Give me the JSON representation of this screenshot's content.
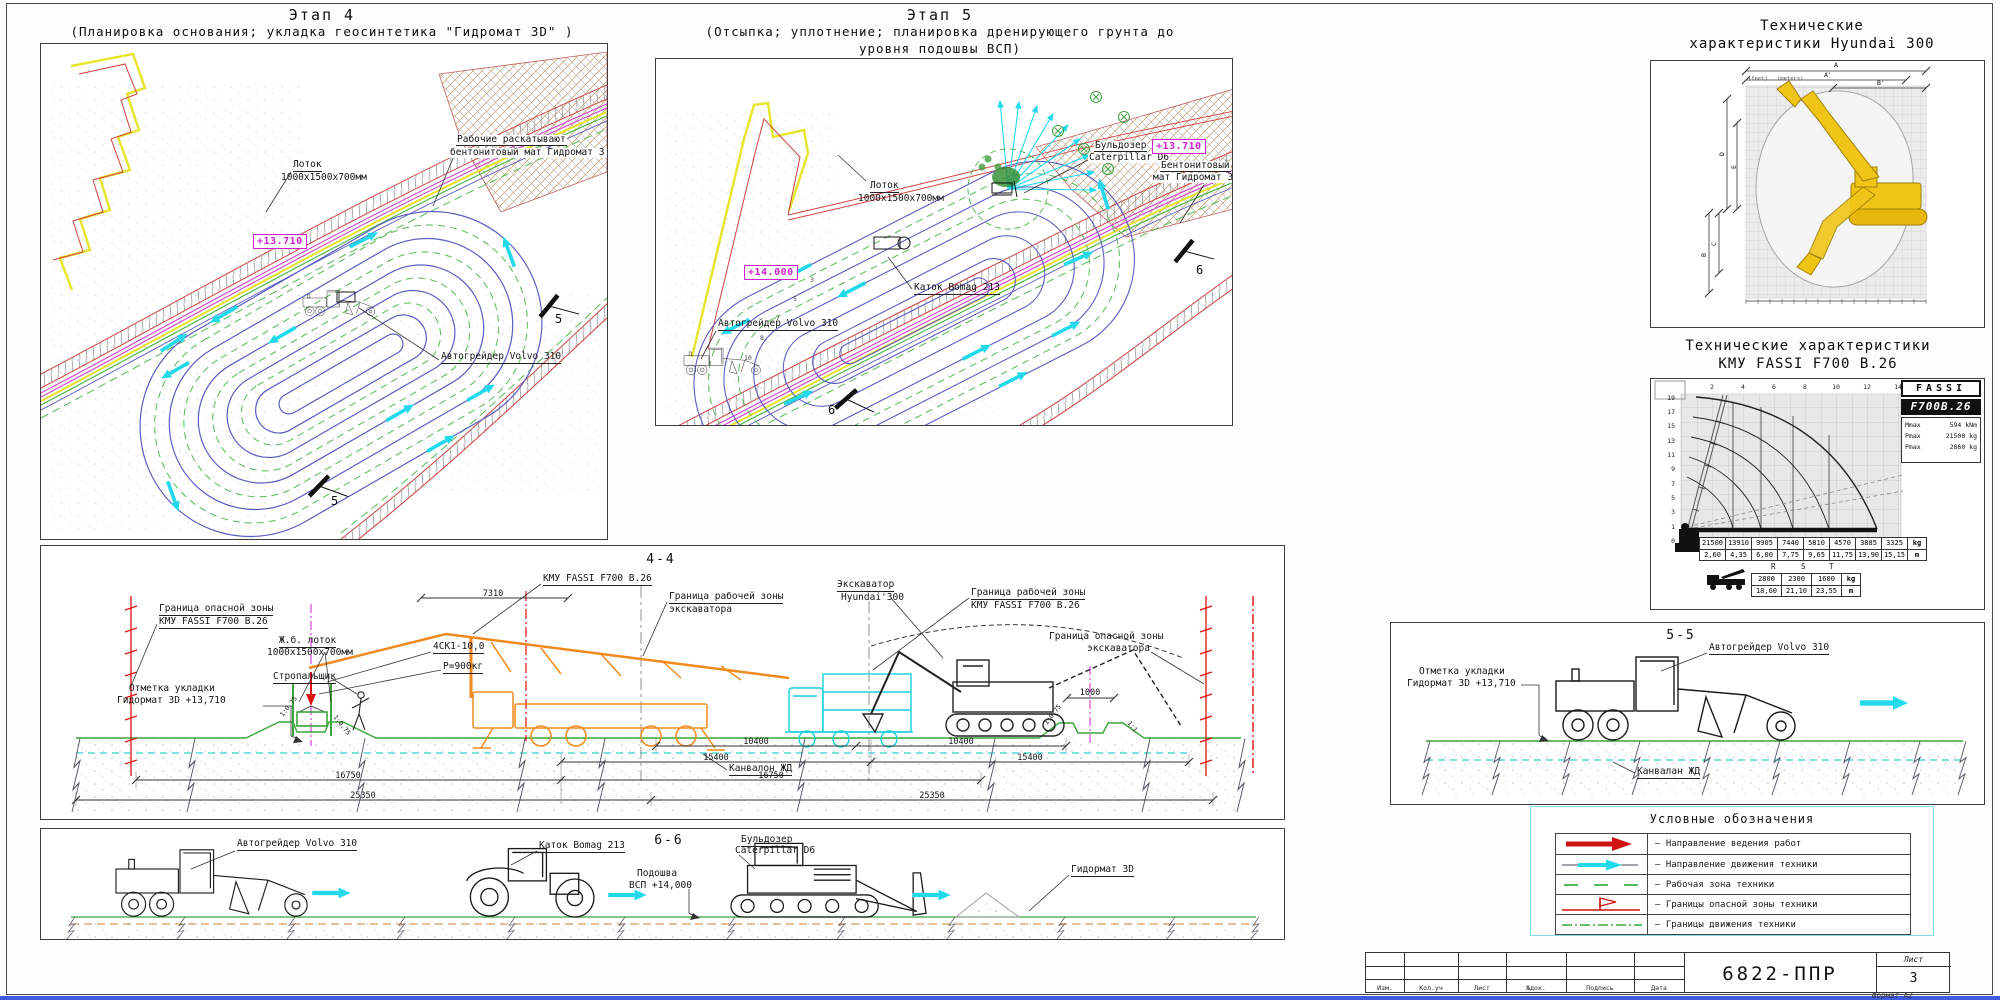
{
  "sheet": {
    "doc_number": "6822-ППР",
    "sheet_word": "Лист",
    "sheet_number": "3",
    "format_note": "Формат А2",
    "titleblock_cols": [
      "Изм.",
      "Кол.уч",
      "Лист",
      "№док.",
      "Подпись",
      "Дата"
    ]
  },
  "s4": {
    "title": "Этап 4",
    "subtitle": "(Планировка основания; укладка геосинтетика \"Гидромат 3D\" )",
    "lotok1": "Лоток",
    "lotok2": "1000х1500х700мм",
    "elev": "+13.710",
    "workers1": "Рабочие раскатывают",
    "workers2": "бентонитовый мат  Гидромат 3 D",
    "grader": "Автогрейдер Volvo 310",
    "marker": "5"
  },
  "s5": {
    "title": "Этап 5",
    "sub1": "(Отсыпка; уплотнение; планировка дренирующего грунта до",
    "sub2": "уровня подошвы ВСП)",
    "dozer1": "Бульдозер",
    "dozer2": "Caterpillar D6",
    "lotok1": "Лоток",
    "lotok2": "1000х1500х700мм",
    "elev_main": "+14.000",
    "elev_right": "+13.710",
    "mat1": "Бентонитовый",
    "mat2": "мат  Гидромат 3 D",
    "roller": "Каток Bomag 213",
    "grader": "Автогрейдер Volvo 310",
    "marker": "6",
    "passes": [
      "10",
      "8",
      "7",
      "5",
      "3"
    ]
  },
  "hy": {
    "t1": "Технические",
    "t2": "характеристики Hyundai 300",
    "top": [
      "A",
      "A'",
      "B'"
    ],
    "left": [
      "D",
      "E",
      "C",
      "B"
    ],
    "feet": "(feet)",
    "meters": "(meters)"
  },
  "fassi": {
    "t1": "Технические характеристики",
    "t2": "КМУ FASSI F700 B.26",
    "logo": "FASSI",
    "model": "F700B.26",
    "specs": [
      {
        "k": "Mmax",
        "v": "594 kNm"
      },
      {
        "k": "Pmax",
        "v": "21500 kg"
      },
      {
        "k": "Pmax",
        "v": "2860 kg"
      }
    ],
    "ax_top": [
      "2",
      "4",
      "6",
      "8",
      "10",
      "12",
      "14"
    ],
    "ax_left": [
      "19",
      "17",
      "15",
      "13",
      "11",
      "9",
      "7",
      "5",
      "3",
      "1",
      "0"
    ],
    "kg": [
      "21500",
      "13910",
      "9905",
      "7440",
      "5810",
      "4570",
      "3885",
      "3325"
    ],
    "m": [
      "2,60",
      "4,35",
      "6,00",
      "7,75",
      "9,65",
      "11,75",
      "13,90",
      "15,15"
    ],
    "ukg": "kg",
    "um": "m",
    "jl": [
      "R",
      "S",
      "T"
    ],
    "jkg": [
      "2800",
      "2300",
      "1600"
    ],
    "jm": [
      "18,60",
      "21,10",
      "23,55"
    ]
  },
  "s44": {
    "title": "4-4",
    "danger_kmu1": "Граница опасной зоны",
    "danger_kmu2": "КМУ FASSI F700 B.26",
    "mark1": "Отметка укладки",
    "mark2": "Гидормат 3D  +13,710",
    "lotok1": "Ж.б. лоток",
    "lotok2": "1000х1500х700мм",
    "rigger": "Стропальщик",
    "sling": "4СК1-10,0",
    "load": "Р=900кг",
    "kmu": "КМУ FASSI F700 B.26",
    "work_exc1": "Граница рабочей зоны",
    "work_exc2": "экскаватора",
    "exc1": "Экскаватор",
    "exc2": "Hyundai'300",
    "work_kmu1": "Граница рабочей зоны",
    "work_kmu2": "КМУ FASSI F700 B.26",
    "danger_exc1": "Граница опасной зоны",
    "danger_exc2": "экскаватора",
    "kan": "Канвалон ЖД",
    "d7310": "7310",
    "d1000": "1000",
    "slope": "1:0,75",
    "slope2": "1:1",
    "d10400": "10400",
    "d15400": "15400",
    "d16750": "16750",
    "d25350": "25350"
  },
  "s55": {
    "title": "5-5",
    "grader": "Автогрейдер Volvo 310",
    "mark1": "Отметка укладки",
    "mark2": "Гидормат 3D  +13,710",
    "kan": "Канвалан ЖД"
  },
  "s66": {
    "title": "6-6",
    "grader": "Автогрейдер Volvo 310",
    "roller": "Каток Bomag 213",
    "dozer1": "Бульдозер",
    "dozer2": "Caterpillar D6",
    "sole1": "Подошва",
    "sole2": "ВСП  +14,000",
    "mat": "Гидормат 3D"
  },
  "legend": {
    "title": "Условные обозначения",
    "items": [
      {
        "text": "– Направление ведения работ"
      },
      {
        "text": "– Направление движения техники"
      },
      {
        "text": "– Рабочая зона техники"
      },
      {
        "text": "– Границы опасной зоны техники"
      },
      {
        "text": "– Границы движения техники"
      }
    ]
  },
  "colors": {
    "work_direction_red": "#d01414",
    "machine_direction_cyan": "#22d9ec",
    "work_zone_green": "#57b857",
    "danger_red": "#e01010",
    "path_blue": "#5b5bc0",
    "elevation_magenta": "#cf1fcf",
    "crane_orange": "#f08a1e"
  }
}
